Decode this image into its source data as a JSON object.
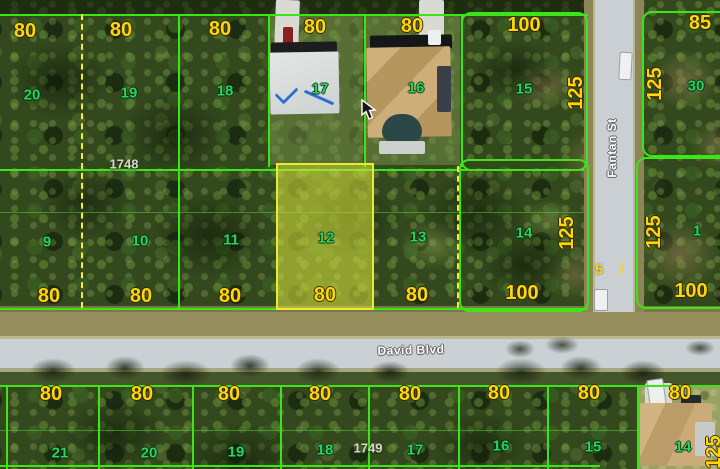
{
  "map": {
    "streets": {
      "horizontal": "David Blvd",
      "vertical": "Fantan St"
    },
    "road_marking": "5",
    "selected_lot": "12",
    "blocks": [
      "1748",
      "1749"
    ],
    "dims_top": [
      "80",
      "80",
      "80",
      "80",
      "80",
      "100",
      "85"
    ],
    "dims_mid": [
      "80",
      "80",
      "80",
      "80",
      "80",
      "100",
      "100"
    ],
    "dims_bottom": [
      "80",
      "80",
      "80",
      "80",
      "80",
      "80",
      "80",
      "80"
    ],
    "dims_side": [
      "125",
      "125",
      "125",
      "125",
      "125"
    ],
    "lots_row1": [
      "20",
      "19",
      "18",
      "17",
      "16",
      "15",
      "30"
    ],
    "lots_row2": [
      "9",
      "10",
      "11",
      "12",
      "13",
      "14",
      "1"
    ],
    "lots_bottom": [
      "21",
      "20",
      "19",
      "18",
      "17",
      "16",
      "15",
      "14"
    ],
    "colors": {
      "lot_line": "#3ce515",
      "boundary_dashed": "#ffe92a",
      "dimension_text": "#ffd60a",
      "lot_number_text": "#2bd45f",
      "block_number_text": "#d6d9cc",
      "street_text": "#ffffff",
      "selected_parcel_fill": "#d7e23c",
      "selected_parcel_border": "#e8ea33",
      "road_surface": "#c9ced2"
    }
  }
}
